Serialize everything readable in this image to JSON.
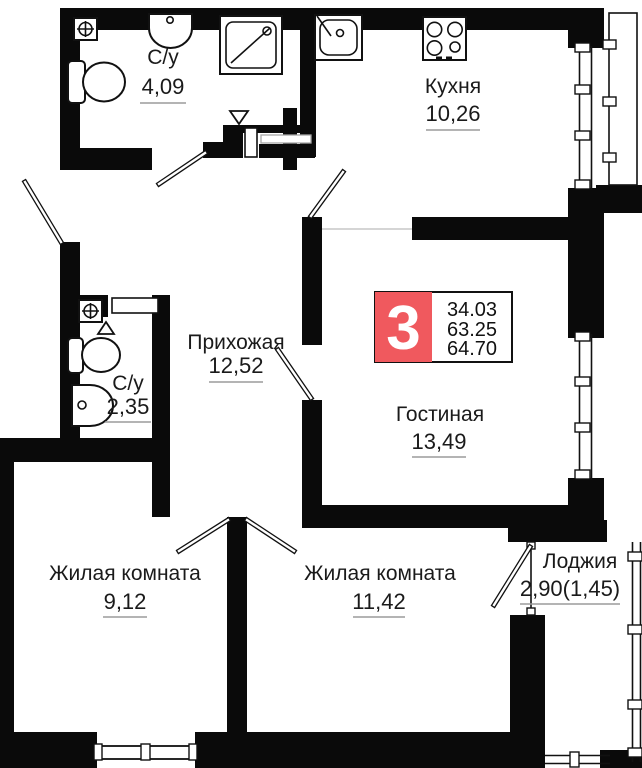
{
  "plan": {
    "colors": {
      "wall": "#0a0a0a",
      "background": "#ffffff",
      "badge_red": "#f0595e",
      "text": "#1a1a1a",
      "underline": "#9b9b9b"
    },
    "badge": {
      "rooms_count": "3",
      "area_lines": [
        "34.03",
        "63.25",
        "64.70"
      ]
    },
    "rooms": {
      "bathroom_top": {
        "name": "С/у",
        "area": "4,09"
      },
      "kitchen": {
        "name": "Кухня",
        "area": "10,26"
      },
      "hallway": {
        "name": "Прихожая",
        "area": "12,52"
      },
      "bathroom_small": {
        "name": "С/у",
        "area": "2,35"
      },
      "living_room": {
        "name": "Гостиная",
        "area": "13,49"
      },
      "bedroom_left": {
        "name": "Жилая комната",
        "area": "9,12"
      },
      "bedroom_right": {
        "name": "Жилая комната",
        "area": "11,42"
      },
      "loggia": {
        "name": "Лоджия",
        "area": "2,90(1,45)"
      }
    }
  }
}
